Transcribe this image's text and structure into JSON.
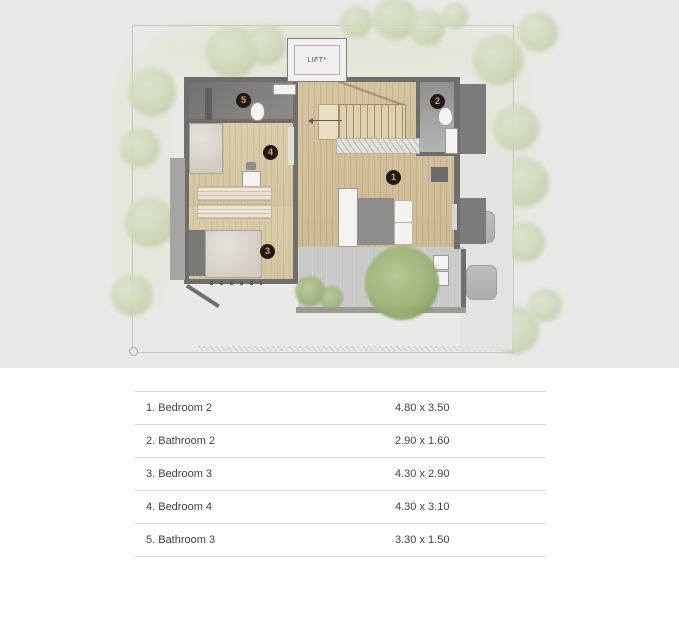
{
  "plan": {
    "lift_label": "LIFT*",
    "markers": [
      {
        "number": "1",
        "room": "Bedroom 2"
      },
      {
        "number": "2",
        "room": "Bathroom 2"
      },
      {
        "number": "3",
        "room": "Bedroom 3"
      },
      {
        "number": "4",
        "room": "Bedroom 4"
      },
      {
        "number": "5",
        "room": "Bathroom 3"
      }
    ]
  },
  "legend": {
    "rows": [
      {
        "name": "1. Bedroom 2",
        "size": "4.80 x 3.50"
      },
      {
        "name": "2. Bathroom 2",
        "size": "2.90 x 1.60"
      },
      {
        "name": "3. Bedroom 3",
        "size": "4.30 x 2.90"
      },
      {
        "name": "4. Bedroom 4",
        "size": "4.30 x 3.10"
      },
      {
        "name": "5. Bathroom 3",
        "size": "3.30 x 1.50"
      }
    ]
  },
  "colors": {
    "background_top": "#e9e9e8",
    "background_bottom": "#ffffff",
    "marker_bg": "#221a12",
    "marker_text": "#d2a972",
    "wood_floor": "#d5c5a2",
    "wall": "#6f6e6c",
    "terrace": "#c9c9c7",
    "tree_soft": "#ccd6b8",
    "tree_green": "#9cb274"
  }
}
